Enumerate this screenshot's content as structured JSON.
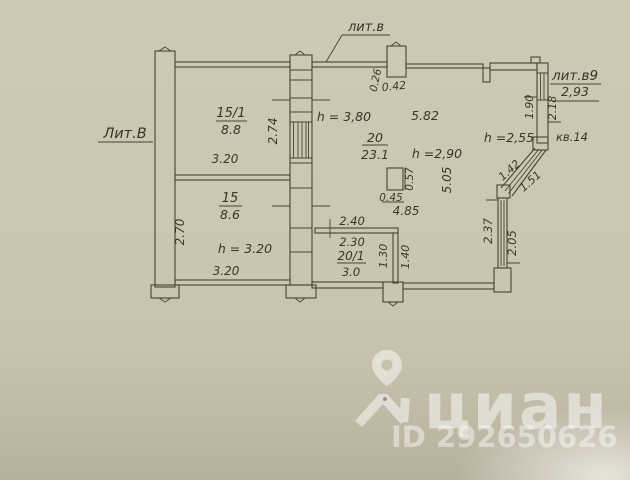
{
  "plan": {
    "labels": {
      "left": "Лит.В",
      "top": "лит.в",
      "right": "лит.в9",
      "right_width": "2,93",
      "apartment": "кв.14"
    },
    "rooms": {
      "r15_1": {
        "num": "15/1",
        "area": "8.8",
        "width": "3.20",
        "depth": "2.74"
      },
      "r15": {
        "num": "15",
        "area": "8.6",
        "width": "3.20",
        "depth": "2.70",
        "height": "h = 3.20"
      },
      "r20": {
        "num": "20",
        "area": "23.1",
        "height_left": "h = 3,80",
        "height": "h =2,90",
        "top": "5.82",
        "side": "5.05",
        "bottom": "4.85"
      },
      "r20_1": {
        "num": "20/1",
        "area": "3.0",
        "w_out": "2.40",
        "w_in": "2.30",
        "d_in": "1.30",
        "d_out": "1.40"
      }
    },
    "bay": {
      "height": "h =2,55",
      "win1": "1.90",
      "win2": "2.18",
      "diag_out": "1.42",
      "diag_in": "1.51",
      "side_out": "2.37",
      "side_in": "2.05"
    },
    "flue": {
      "top_w1": "0.26",
      "top_w2": "0.42",
      "col_w": "0.45",
      "col_h": "0.57"
    }
  },
  "watermark": {
    "brand": "циан",
    "id": "ID 292650626"
  }
}
